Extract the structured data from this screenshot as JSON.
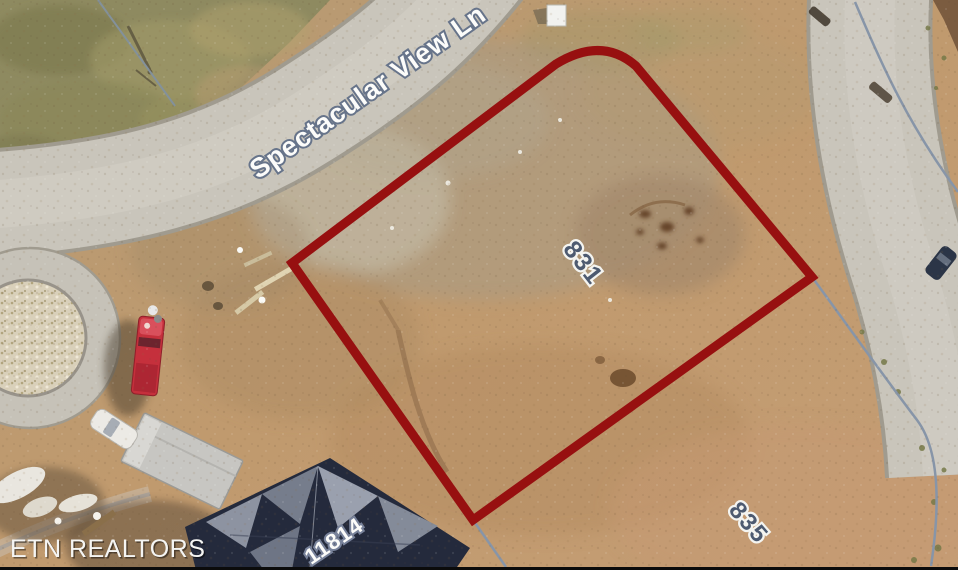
{
  "map": {
    "type": "aerial-parcel-view",
    "street_label": "Spectacular View Ln",
    "lot_label": "831",
    "adjacent_lot_label": "835",
    "house_number_label": "11814",
    "watermark": "ETN REALTORS",
    "colors": {
      "boundary_outline": "#971010",
      "road_surface": "#c9c5bb",
      "road_edge": "#a09b8f",
      "dirt": "#bf9c72",
      "grass": "#8e8a60",
      "parcel_line": "#8795a8",
      "street_label_fill": "#fcfcfa",
      "street_label_outline": "#67748a",
      "lot_label_fill": "#4d5a70",
      "lot_label_halo": "#f4f4f0",
      "roof": "#242a3c",
      "pickup_truck": "#c5303c",
      "watermark_color": "#f5f5f3"
    }
  }
}
